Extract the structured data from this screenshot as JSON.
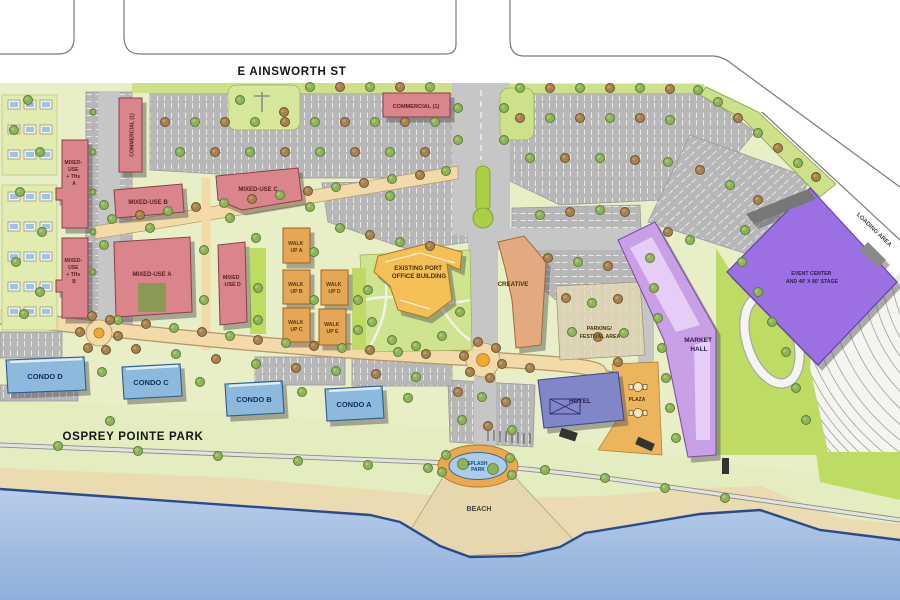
{
  "palette": {
    "mixed_use": "#d9858b",
    "commercial": "#d9858b",
    "walk_up": "#e5a757",
    "condo": "#8db9dc",
    "hotel": "#8186c8",
    "market_hall": "#c9a0e6",
    "event_center": "#9b70e2",
    "port_office": "#f3bf57",
    "creative": "#e3a97f",
    "water_top": "#b9cde9",
    "water_bottom": "#8fafdb",
    "sand": "#eadcb0",
    "park_green": "#e3edc0",
    "lawn_green": "#bedc64",
    "street_peach": "#f2daa9",
    "road_gray": "#c6c6c6",
    "parking_gray": "#b7b7b7"
  },
  "streets": {
    "e_ainsworth": "E AINSWORTH ST"
  },
  "areas": {
    "park": "OSPREY POINTE PARK",
    "beach": "BEACH",
    "splash_park": [
      "SPLASH",
      "PARK"
    ],
    "loading_area": "LOADING AREA",
    "parking_festival": [
      "PARKING/",
      "FESTIVAL AREA"
    ],
    "plaza": "PLAZA"
  },
  "buildings": {
    "commercial_west": "COMMERCIAL (1)",
    "commercial_north": "COMMERCIAL (1)",
    "mixed_use_ths_a": [
      "MIXED-",
      "USE",
      "+ THs",
      "A"
    ],
    "mixed_use_ths_b": [
      "MIXED-",
      "USE",
      "+ THs",
      "B"
    ],
    "mixed_use_a": "MIXED-USE A",
    "mixed_use_b": "MIXED-USE B",
    "mixed_use_c": "MIXED-USE C",
    "mixed_use_d": [
      "MIXED",
      "-USE D"
    ],
    "walk_up_a": [
      "WALK",
      "UP A"
    ],
    "walk_up_b": [
      "WALK",
      "UP B"
    ],
    "walk_up_c": [
      "WALK",
      "UP C"
    ],
    "walk_up_d": [
      "WALK",
      "UP D"
    ],
    "walk_up_e": [
      "WALK",
      "UP E"
    ],
    "port_office": [
      "EXISTING PORT",
      "OFFICE BUILDING"
    ],
    "creative": "CREATIVE",
    "market_hall": [
      "MARKET",
      "HALL"
    ],
    "event_center": [
      "EVENT CENTER",
      "AND 40' X 80' STAGE"
    ],
    "hotel": "HOTEL",
    "condo_a": "CONDO A",
    "condo_b": "CONDO B",
    "condo_c": "CONDO C",
    "condo_d": "CONDO D"
  }
}
